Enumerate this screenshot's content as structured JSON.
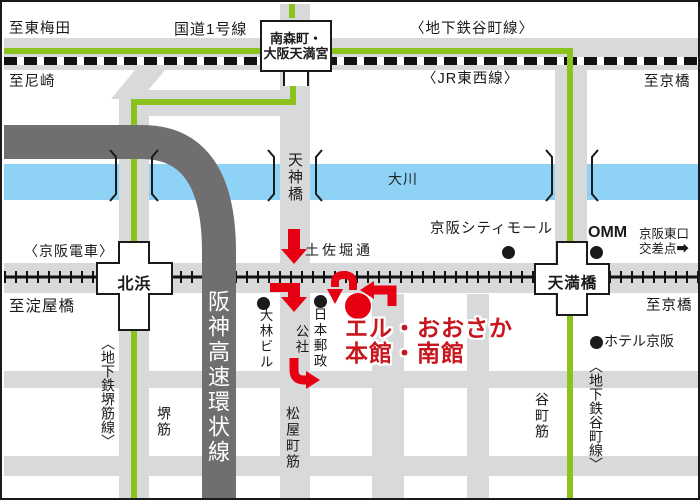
{
  "edges": {
    "to_higashi_umeda": "至東梅田",
    "to_amagasaki": "至尼崎",
    "to_kyobashi_top": "至京橋",
    "to_kyobashi_right": "至京橋",
    "to_yodoyabashi": "至淀屋橋"
  },
  "roads_rails": {
    "route1": "国道1号線",
    "tanimachi_line_top": "〈地下鉄谷町線〉",
    "jr_tozai_line": "〈JR東西線〉",
    "keihan_railway": "〈京阪電車〉",
    "sakaisuji_line": "〈地下鉄堺筋線〉",
    "tanimachi_line_bottom": "〈地下鉄谷町線〉",
    "tosabori_dori": "土佐堀通",
    "sakaisuji_street": "堺筋",
    "matsuyamachi_suji": "松屋町筋",
    "tanimachi_suji": "谷町筋",
    "hanshin_expressway": "阪神高速環状線"
  },
  "stations": {
    "minamimorimachi_line1": "南森町・",
    "minamimorimachi_line2": "大阪天満宮",
    "kitahama": "北浜",
    "temmabashi": "天満橋"
  },
  "river": {
    "name": "大川"
  },
  "bridge": {
    "tenjinbashi": "天神橋"
  },
  "landmarks": {
    "keihan_city_mall": "京阪シティモール",
    "omm": "OMM",
    "keihan_east_exit_line1": "京阪東口",
    "keihan_east_exit_line2": "交差点",
    "keihan_east_exit_arrow": "➡",
    "obayashi_building": "大林ビル",
    "japan_post_line1": "日本郵政",
    "japan_post_line2": "公社",
    "hotel_keihan": "ホテル京阪",
    "l_osaka_line1": "エル・おおさか",
    "l_osaka_line2": "本館・南館"
  },
  "colors": {
    "road_gray": "#d8d9da",
    "expressway_gray": "#706e6f",
    "river_blue": "#8ed3f5",
    "subway_green": "#8cc21e",
    "route_arrow_red": "#e60012",
    "l_osaka_red": "#c7161d",
    "line_black": "#1a1a1a"
  }
}
